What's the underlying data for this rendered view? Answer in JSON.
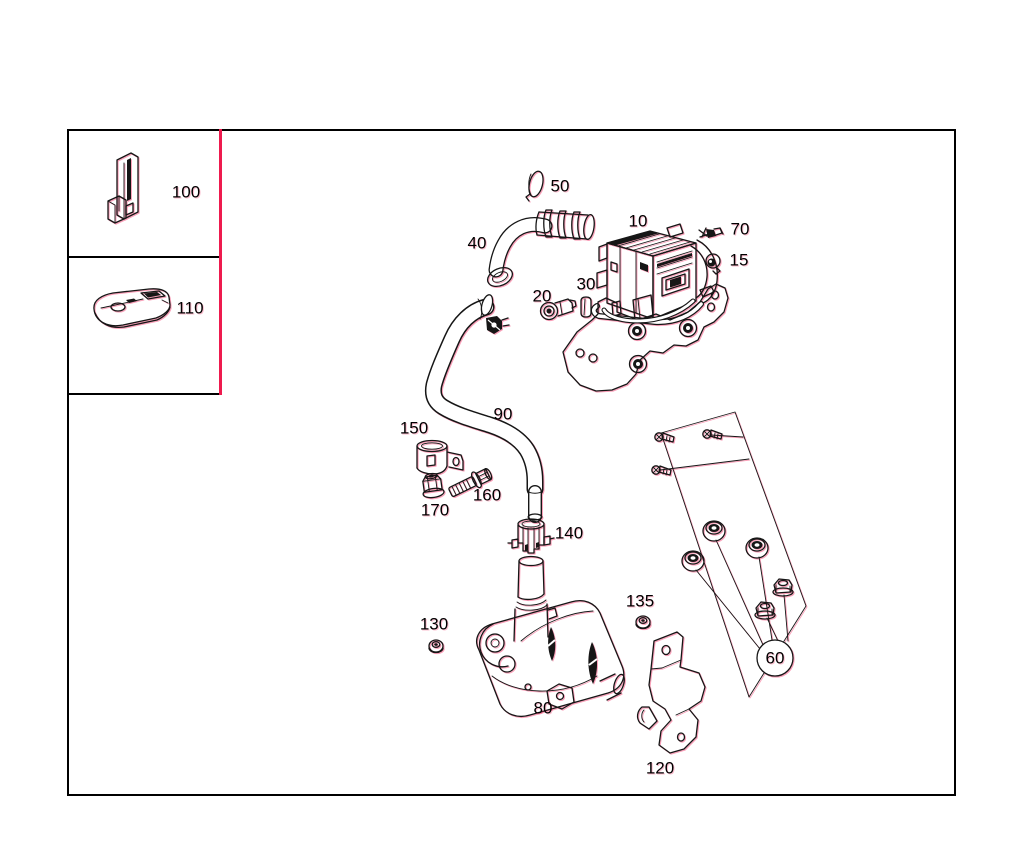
{
  "diagram": {
    "type": "exploded-parts-diagram",
    "colors": {
      "line": "#161616",
      "accent": "#ee1a4e",
      "background": "#ffffff"
    },
    "callout": {
      "label": "60"
    },
    "parts": {
      "p10": {
        "label": "10"
      },
      "p15": {
        "label": "15"
      },
      "p20": {
        "label": "20"
      },
      "p30": {
        "label": "30"
      },
      "p40": {
        "label": "40"
      },
      "p50": {
        "label": "50"
      },
      "p60": {
        "label": "60"
      },
      "p70": {
        "label": "70"
      },
      "p80": {
        "label": "80"
      },
      "p90": {
        "label": "90"
      },
      "p100": {
        "label": "100"
      },
      "p110": {
        "label": "110"
      },
      "p120": {
        "label": "120"
      },
      "p130": {
        "label": "130"
      },
      "p135": {
        "label": "135"
      },
      "p140": {
        "label": "140"
      },
      "p150": {
        "label": "150"
      },
      "p160": {
        "label": "160"
      },
      "p170": {
        "label": "170"
      }
    }
  }
}
